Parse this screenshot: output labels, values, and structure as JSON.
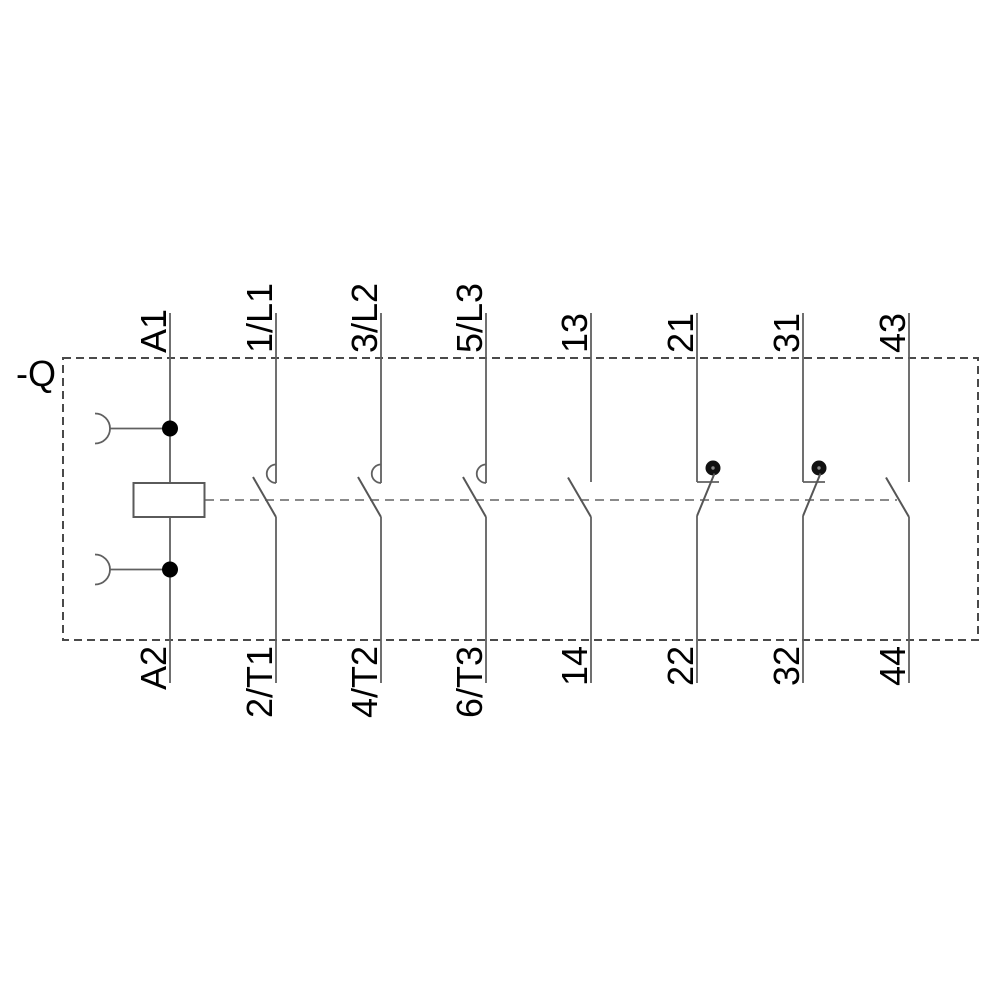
{
  "device": {
    "designation": "-Q"
  },
  "colors": {
    "background": "#ffffff",
    "line": "#606060",
    "enclosure_dash": "#4a4a4a",
    "link_dash": "#7a7a7a",
    "label_text": "#000000",
    "junction_dot": "#000000"
  },
  "poles": [
    {
      "kind": "coil",
      "top_terminal": "A1",
      "bottom_terminal": "A2"
    },
    {
      "kind": "main-contact-no",
      "top_terminal": "1/L1",
      "bottom_terminal": "2/T1"
    },
    {
      "kind": "main-contact-no",
      "top_terminal": "3/L2",
      "bottom_terminal": "4/T2"
    },
    {
      "kind": "main-contact-no",
      "top_terminal": "5/L3",
      "bottom_terminal": "6/T3"
    },
    {
      "kind": "aux-contact-no",
      "top_terminal": "13",
      "bottom_terminal": "14"
    },
    {
      "kind": "aux-contact-nc",
      "top_terminal": "21",
      "bottom_terminal": "22"
    },
    {
      "kind": "aux-contact-nc",
      "top_terminal": "31",
      "bottom_terminal": "32"
    },
    {
      "kind": "aux-contact-no",
      "top_terminal": "43",
      "bottom_terminal": "44"
    }
  ]
}
